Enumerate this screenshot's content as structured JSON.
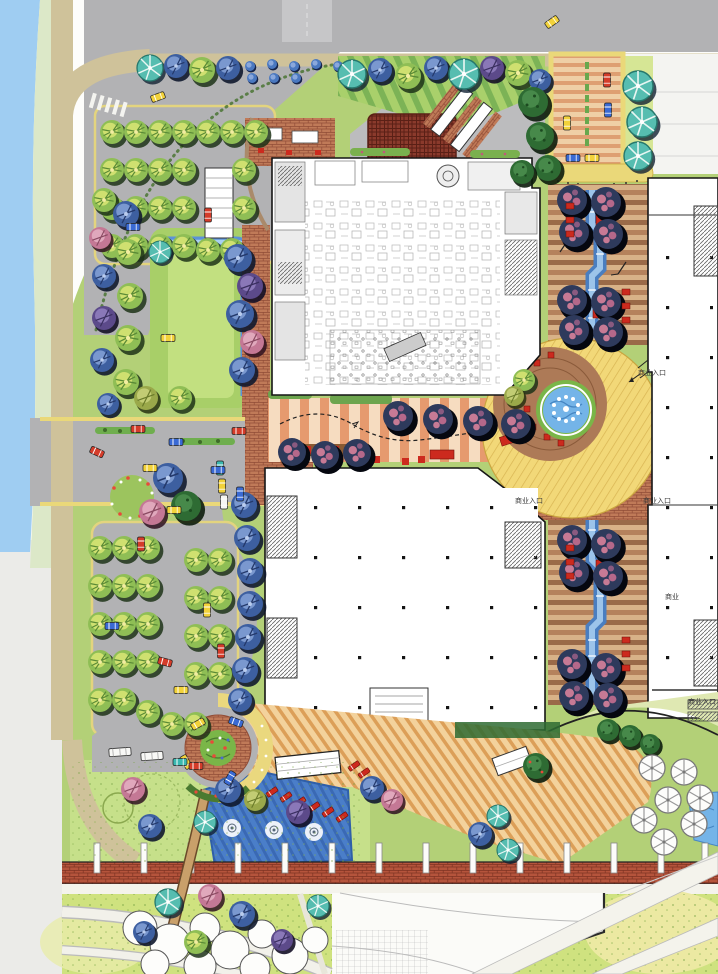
{
  "labels": {
    "entrance_ne": {
      "text": "商业入口"
    },
    "entrance_sw": {
      "text": "商业入口"
    },
    "entrance_se": {
      "text": "商业入口"
    },
    "entrance_east": {
      "text": "商业入口"
    },
    "commercial": {
      "text": "商业"
    }
  },
  "palette": {
    "water": "#9fcdf2",
    "road": "#b2b2b4",
    "sidewalk": "#cfc29a",
    "curb_yellow": "#ead879",
    "lawn": "#b3d077",
    "brick": "#c07a58",
    "pergola": "#8a3a2c",
    "deck": "#f3d29c",
    "plaza_yellow": "#f2d878",
    "plaza_brown": "#ad7a57",
    "pond": "#4a7ec9",
    "pool": "#74b4e8",
    "bench_red": "#cc2a1e",
    "building": "#ffffff",
    "outline": "#1a1a1a",
    "mall_stripe": "#9a6a48"
  }
}
